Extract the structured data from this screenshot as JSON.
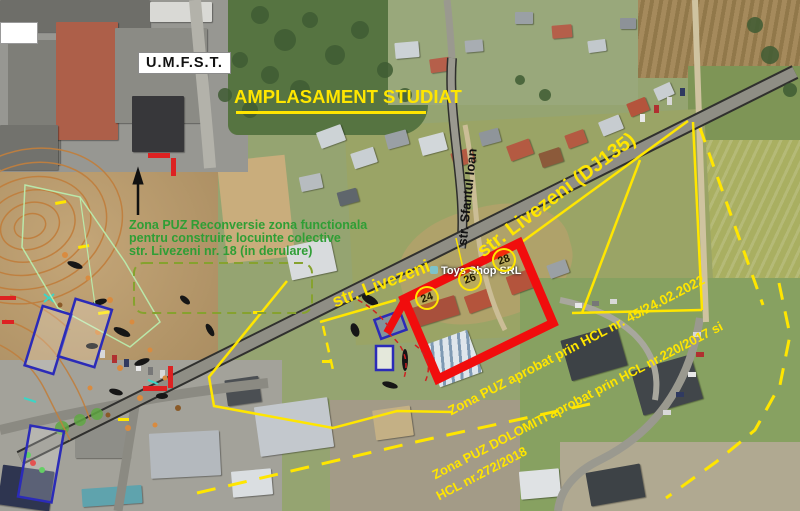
{
  "map": {
    "labels": {
      "institution": "U.M.F.S.T.",
      "title": "AMPLASAMENT STUDIAT",
      "business": "Toys Shop SRL"
    },
    "reconversie_note": {
      "line1": "Zona PUZ Reconversie zona functionala",
      "line2": "pentru construire locuinte colective",
      "line3": "str. Livezeni nr. 18 (in derulare)"
    },
    "streets": {
      "livezeni_dj": "str. Livezeni (DJ135)",
      "livezeni": "str. Livezeni",
      "sfantul_ioan": "str. Sfantul Ioan"
    },
    "zones": {
      "zone45": "Zona PUZ aprobat prin HCL nr. 45/24.02.2022",
      "dolomiti_line1": "Zona PUZ DOLOMITI aprobat prin HCL nr.220/2017 si",
      "dolomiti_line2": "HCL nr.272/2018"
    },
    "house_numbers": {
      "n24": "24",
      "n26": "26",
      "n28": "28"
    },
    "colors": {
      "annotation_yellow": "#ffe600",
      "annotation_red": "#ee1111",
      "note_green": "#2f9e35",
      "street_label_black": "#111111"
    }
  }
}
